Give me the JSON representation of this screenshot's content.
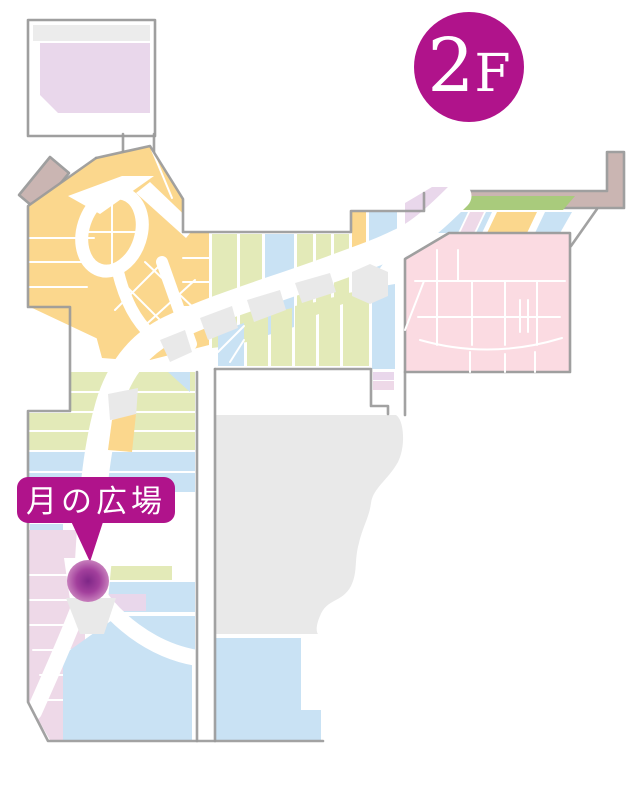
{
  "floor_badge": {
    "number": "2",
    "suffix": "F"
  },
  "location_callout": {
    "label": "月の広場"
  },
  "colors": {
    "accent": "#b0138b",
    "outline": "#9a9a9a",
    "orange": "#fbd78d",
    "green": "#e3eab8",
    "olive": "#a9cb7c",
    "blue": "#c9e2f4",
    "pink": "#fbdae1",
    "lavender": "#e9d7eb",
    "pink_lavender": "#eed9e8",
    "tan": "#c8b2ae",
    "island": "#e9e9e9",
    "marker_center": "#7e2787",
    "marker_mid": "#a23f9c",
    "marker_edge": "#c77fbc",
    "background": "#ffffff"
  }
}
